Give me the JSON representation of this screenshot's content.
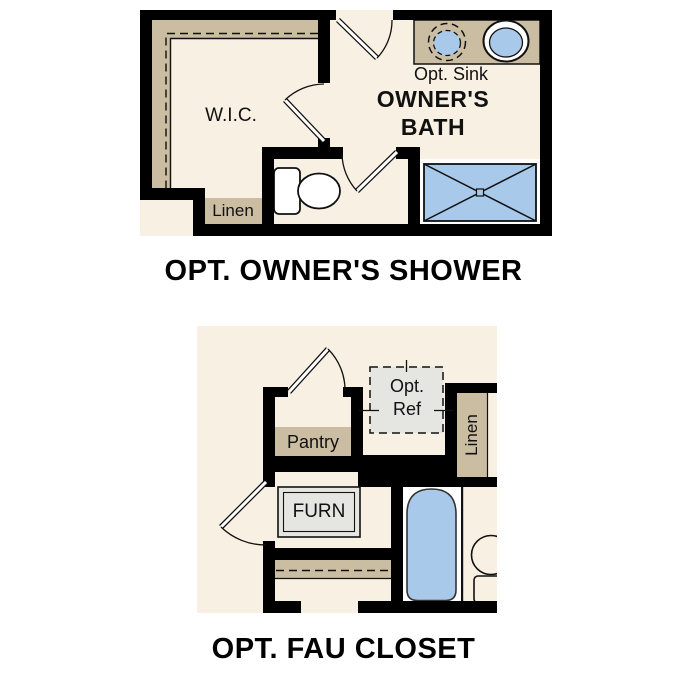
{
  "colors": {
    "page": "#ffffff",
    "floor": "#f8f1e3",
    "shelf": "#cbbda1",
    "fixture": "#a9c9eb",
    "equipment": "#e5e5e2",
    "wall": "#000000"
  },
  "plans": [
    {
      "id": "owners-shower",
      "title": "OPT. OWNER'S SHOWER",
      "labels": {
        "wic": "W.I.C.",
        "linen": "Linen",
        "opt_sink": "Opt. Sink",
        "bath_line1": "OWNER'S",
        "bath_line2": "BATH"
      }
    },
    {
      "id": "fau-closet",
      "title": "OPT. FAU CLOSET",
      "labels": {
        "pantry": "Pantry",
        "opt_ref_line1": "Opt.",
        "opt_ref_line2": "Ref",
        "linen": "Linen",
        "furn": "FURN"
      }
    }
  ]
}
